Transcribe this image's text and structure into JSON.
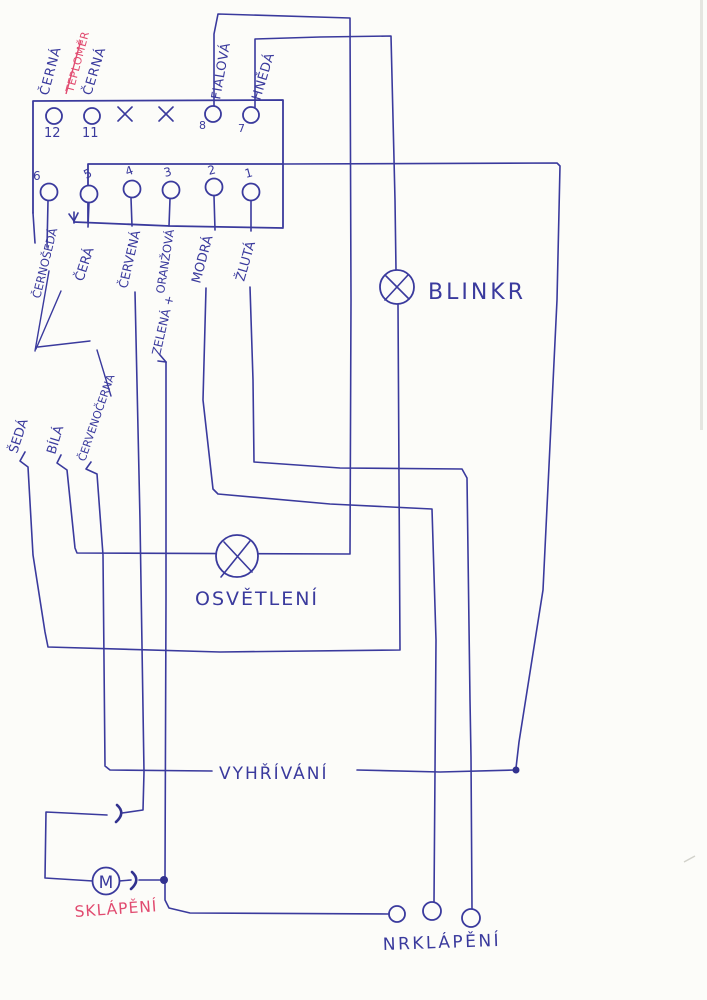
{
  "colors": {
    "ink": "#3a3a9d",
    "red": "#e14b70",
    "paper": "#fcfcf9"
  },
  "connector": {
    "pin_numbers_top": [
      "12",
      "11",
      "8",
      "7"
    ],
    "pin_numbers_bottom": [
      "6",
      "5",
      "4",
      "3",
      "2",
      "1"
    ]
  },
  "wire_labels": {
    "cerna_1": "ČERNÁ",
    "teplomer": "TEPLOMĚR",
    "cerna_2": "ČERNÁ",
    "fialova": "FIALOVÁ",
    "hneda": "HNĚDÁ",
    "cernoseda": "ČERNOŠEDÁ",
    "cera": "ČERÁ",
    "cervena": "ČERVENÁ",
    "oranzova": "ORANŽOVÁ",
    "zelena_plus": "ZELENÁ +",
    "modra": "MODRÁ",
    "zluta": "ŽLUTÁ",
    "seda": "ŠEDÁ",
    "bila": "BÍLÁ",
    "cervenocerna": "ČERVENOČERNÁ"
  },
  "components": {
    "blinkr": "BLINKR",
    "osvetleni": "OSVĚTLENÍ",
    "vyhrivani": "VYHŘÍVÁNÍ",
    "sklapeni": "SKLÁPĚNÍ",
    "nrklapeni": "NRKLÁPĚNÍ",
    "motor": "M"
  }
}
